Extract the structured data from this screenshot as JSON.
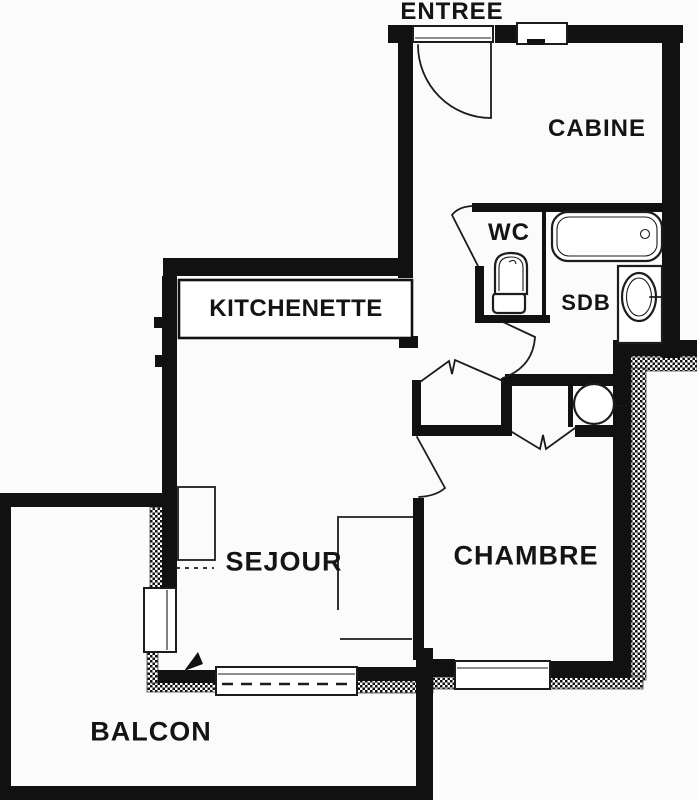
{
  "rooms": {
    "entree": "ENTREE",
    "cabine": "CABINE",
    "wc": "WC",
    "sdb": "SDB",
    "kitchenette": "KITCHENETTE",
    "sejour": "SEJOUR",
    "chambre": "CHAMBRE",
    "balcon": "BALCON"
  },
  "colors": {
    "background": "#fbfbfb",
    "wall": "#111111",
    "line": "#1c1c1c"
  }
}
